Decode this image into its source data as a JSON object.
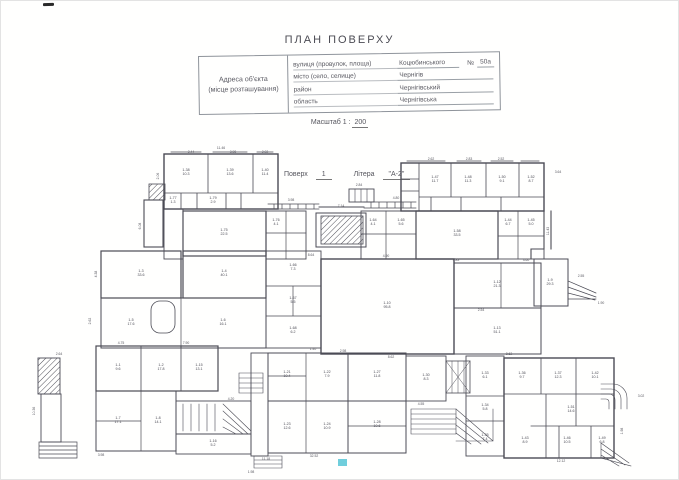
{
  "header": {
    "title": "ПЛАН ПОВЕРХУ"
  },
  "address_table": {
    "label_line1": "Адреса об'єкта",
    "label_line2": "(місце розташування)",
    "rows": [
      {
        "label": "вулиця (провулок, площа)",
        "value": "Коцюбинського",
        "num_label": "№",
        "num_value": "50а"
      },
      {
        "label": "місто (село, селище)",
        "value": "Чернігів"
      },
      {
        "label": "район",
        "value": "Чернігівський"
      },
      {
        "label": "область",
        "value": "Чернігівська"
      }
    ]
  },
  "scale_line": {
    "label": "Масштаб 1 :",
    "value": "200"
  },
  "floor_line": {
    "floor_label": "Поверх",
    "floor_value": "1",
    "letter_label": "Літера",
    "letter_value": "\"А-2\""
  },
  "plan": {
    "ink": "#4b4b55",
    "accent_mark": "#57c5d6",
    "rooms": [
      {
        "x": 185,
        "y": 170,
        "n": "1-38",
        "a": "10.3"
      },
      {
        "x": 229,
        "y": 170,
        "n": "1-39",
        "a": "13.6"
      },
      {
        "x": 264,
        "y": 170,
        "n": "1-40",
        "a": "11.4"
      },
      {
        "x": 172,
        "y": 198,
        "n": "1-77",
        "a": "1.3"
      },
      {
        "x": 212,
        "y": 198,
        "n": "1-79",
        "a": "2.9"
      },
      {
        "x": 434,
        "y": 177,
        "n": "1-47",
        "a": "11.7"
      },
      {
        "x": 467,
        "y": 177,
        "n": "1-48",
        "a": "11.3"
      },
      {
        "x": 501,
        "y": 177,
        "n": "1-50",
        "a": "9.1"
      },
      {
        "x": 530,
        "y": 177,
        "n": "1-52",
        "a": "8.7"
      },
      {
        "x": 223,
        "y": 230,
        "n": "1-75",
        "a": "22.5"
      },
      {
        "x": 275,
        "y": 220,
        "n": "1-76",
        "a": "4.1"
      },
      {
        "x": 372,
        "y": 220,
        "n": "1-64",
        "a": "4.1"
      },
      {
        "x": 400,
        "y": 220,
        "n": "1-65",
        "a": "5.6"
      },
      {
        "x": 456,
        "y": 231,
        "n": "1-58",
        "a": "33.5"
      },
      {
        "x": 507,
        "y": 220,
        "n": "1-44",
        "a": "6.7"
      },
      {
        "x": 530,
        "y": 220,
        "n": "1-45",
        "a": "5.0"
      },
      {
        "x": 140,
        "y": 271,
        "n": "1-3",
        "a": "33.6"
      },
      {
        "x": 223,
        "y": 271,
        "n": "1-4",
        "a": "40.1"
      },
      {
        "x": 130,
        "y": 320,
        "n": "1-5",
        "a": "17.6"
      },
      {
        "x": 222,
        "y": 320,
        "n": "1-6",
        "a": "16.1"
      },
      {
        "x": 292,
        "y": 265,
        "n": "1-66",
        "a": "7.3"
      },
      {
        "x": 292,
        "y": 298,
        "n": "1-67",
        "a": "5.5"
      },
      {
        "x": 292,
        "y": 328,
        "n": "1-68",
        "a": "6.2"
      },
      {
        "x": 386,
        "y": 303,
        "n": "1-10",
        "a": "95.8"
      },
      {
        "x": 496,
        "y": 282,
        "n": "1-12",
        "a": "21.3"
      },
      {
        "x": 496,
        "y": 328,
        "n": "1-13",
        "a": "51.1"
      },
      {
        "x": 549,
        "y": 280,
        "n": "1-9",
        "a": "29.3"
      },
      {
        "x": 117,
        "y": 365,
        "n": "1-1",
        "a": "9.6"
      },
      {
        "x": 160,
        "y": 365,
        "n": "1-2",
        "a": "17.8"
      },
      {
        "x": 198,
        "y": 365,
        "n": "1-15",
        "a": "13.1"
      },
      {
        "x": 117,
        "y": 418,
        "n": "1-7",
        "a": "17.1"
      },
      {
        "x": 157,
        "y": 418,
        "n": "1-8",
        "a": "14.1"
      },
      {
        "x": 212,
        "y": 441,
        "n": "1-16",
        "a": "5.2"
      },
      {
        "x": 286,
        "y": 372,
        "n": "1-21",
        "a": "10.4"
      },
      {
        "x": 326,
        "y": 372,
        "n": "1-22",
        "a": "7.9"
      },
      {
        "x": 286,
        "y": 424,
        "n": "1-23",
        "a": "12.6"
      },
      {
        "x": 326,
        "y": 424,
        "n": "1-24",
        "a": "10.9"
      },
      {
        "x": 376,
        "y": 372,
        "n": "1-27",
        "a": "11.8"
      },
      {
        "x": 376,
        "y": 422,
        "n": "1-28",
        "a": "10.6"
      },
      {
        "x": 425,
        "y": 375,
        "n": "1-30",
        "a": "8.3"
      },
      {
        "x": 484,
        "y": 373,
        "n": "1-33",
        "a": "6.1"
      },
      {
        "x": 484,
        "y": 405,
        "n": "1-34",
        "a": "5.8"
      },
      {
        "x": 484,
        "y": 435,
        "n": "1-35",
        "a": "7.4"
      },
      {
        "x": 521,
        "y": 373,
        "n": "1-36",
        "a": "9.7"
      },
      {
        "x": 557,
        "y": 373,
        "n": "1-37",
        "a": "12.3"
      },
      {
        "x": 594,
        "y": 373,
        "n": "1-42",
        "a": "10.1"
      },
      {
        "x": 570,
        "y": 407,
        "n": "1-51",
        "a": "14.6"
      },
      {
        "x": 524,
        "y": 438,
        "n": "1-43",
        "a": "8.9"
      },
      {
        "x": 566,
        "y": 438,
        "n": "1-46",
        "a": "10.5"
      },
      {
        "x": 601,
        "y": 438,
        "n": "1-49",
        "a": "6.8"
      }
    ],
    "dims": [
      {
        "x": 220,
        "y": 148,
        "t": "11.46"
      },
      {
        "x": 190,
        "y": 152,
        "t": "2.44"
      },
      {
        "x": 232,
        "y": 152,
        "t": "3.98"
      },
      {
        "x": 264,
        "y": 152,
        "t": "2.02"
      },
      {
        "x": 158,
        "y": 175,
        "t": "2.06",
        "r": 1
      },
      {
        "x": 140,
        "y": 225,
        "t": "6.08",
        "r": 1
      },
      {
        "x": 96,
        "y": 273,
        "t": "4.38",
        "r": 1
      },
      {
        "x": 90,
        "y": 320,
        "t": "2.62",
        "r": 1
      },
      {
        "x": 58,
        "y": 354,
        "t": "2.64"
      },
      {
        "x": 34,
        "y": 410,
        "t": "10.36",
        "r": 1
      },
      {
        "x": 430,
        "y": 159,
        "t": "2.62"
      },
      {
        "x": 468,
        "y": 159,
        "t": "2.83"
      },
      {
        "x": 500,
        "y": 159,
        "t": "2.52"
      },
      {
        "x": 557,
        "y": 172,
        "t": "3.64"
      },
      {
        "x": 548,
        "y": 230,
        "t": "11.43",
        "r": 1
      },
      {
        "x": 340,
        "y": 206,
        "t": "7.14"
      },
      {
        "x": 395,
        "y": 198,
        "t": "4.80"
      },
      {
        "x": 358,
        "y": 185,
        "t": "2.84"
      },
      {
        "x": 290,
        "y": 200,
        "t": "3.98"
      },
      {
        "x": 310,
        "y": 255,
        "t": "8.64"
      },
      {
        "x": 385,
        "y": 256,
        "t": "4.90"
      },
      {
        "x": 455,
        "y": 260,
        "t": "4.83"
      },
      {
        "x": 525,
        "y": 260,
        "t": "3.60"
      },
      {
        "x": 390,
        "y": 357,
        "t": "8.62"
      },
      {
        "x": 480,
        "y": 310,
        "t": "2.54"
      },
      {
        "x": 580,
        "y": 276,
        "t": "2.55"
      },
      {
        "x": 600,
        "y": 303,
        "t": "1.90"
      },
      {
        "x": 120,
        "y": 343,
        "t": "4.75"
      },
      {
        "x": 185,
        "y": 343,
        "t": "7.90"
      },
      {
        "x": 230,
        "y": 399,
        "t": "4.20"
      },
      {
        "x": 312,
        "y": 349,
        "t": "1.40"
      },
      {
        "x": 342,
        "y": 351,
        "t": "2.98"
      },
      {
        "x": 265,
        "y": 459,
        "t": "11.18"
      },
      {
        "x": 313,
        "y": 456,
        "t": "32.52"
      },
      {
        "x": 420,
        "y": 404,
        "t": "4.55"
      },
      {
        "x": 508,
        "y": 354,
        "t": "8.62"
      },
      {
        "x": 622,
        "y": 430,
        "t": "1.98",
        "r": 1
      },
      {
        "x": 640,
        "y": 396,
        "t": "3.02"
      },
      {
        "x": 560,
        "y": 461,
        "t": "12.12"
      },
      {
        "x": 100,
        "y": 455,
        "t": "3.98"
      },
      {
        "x": 250,
        "y": 472,
        "t": "1.98"
      }
    ]
  }
}
